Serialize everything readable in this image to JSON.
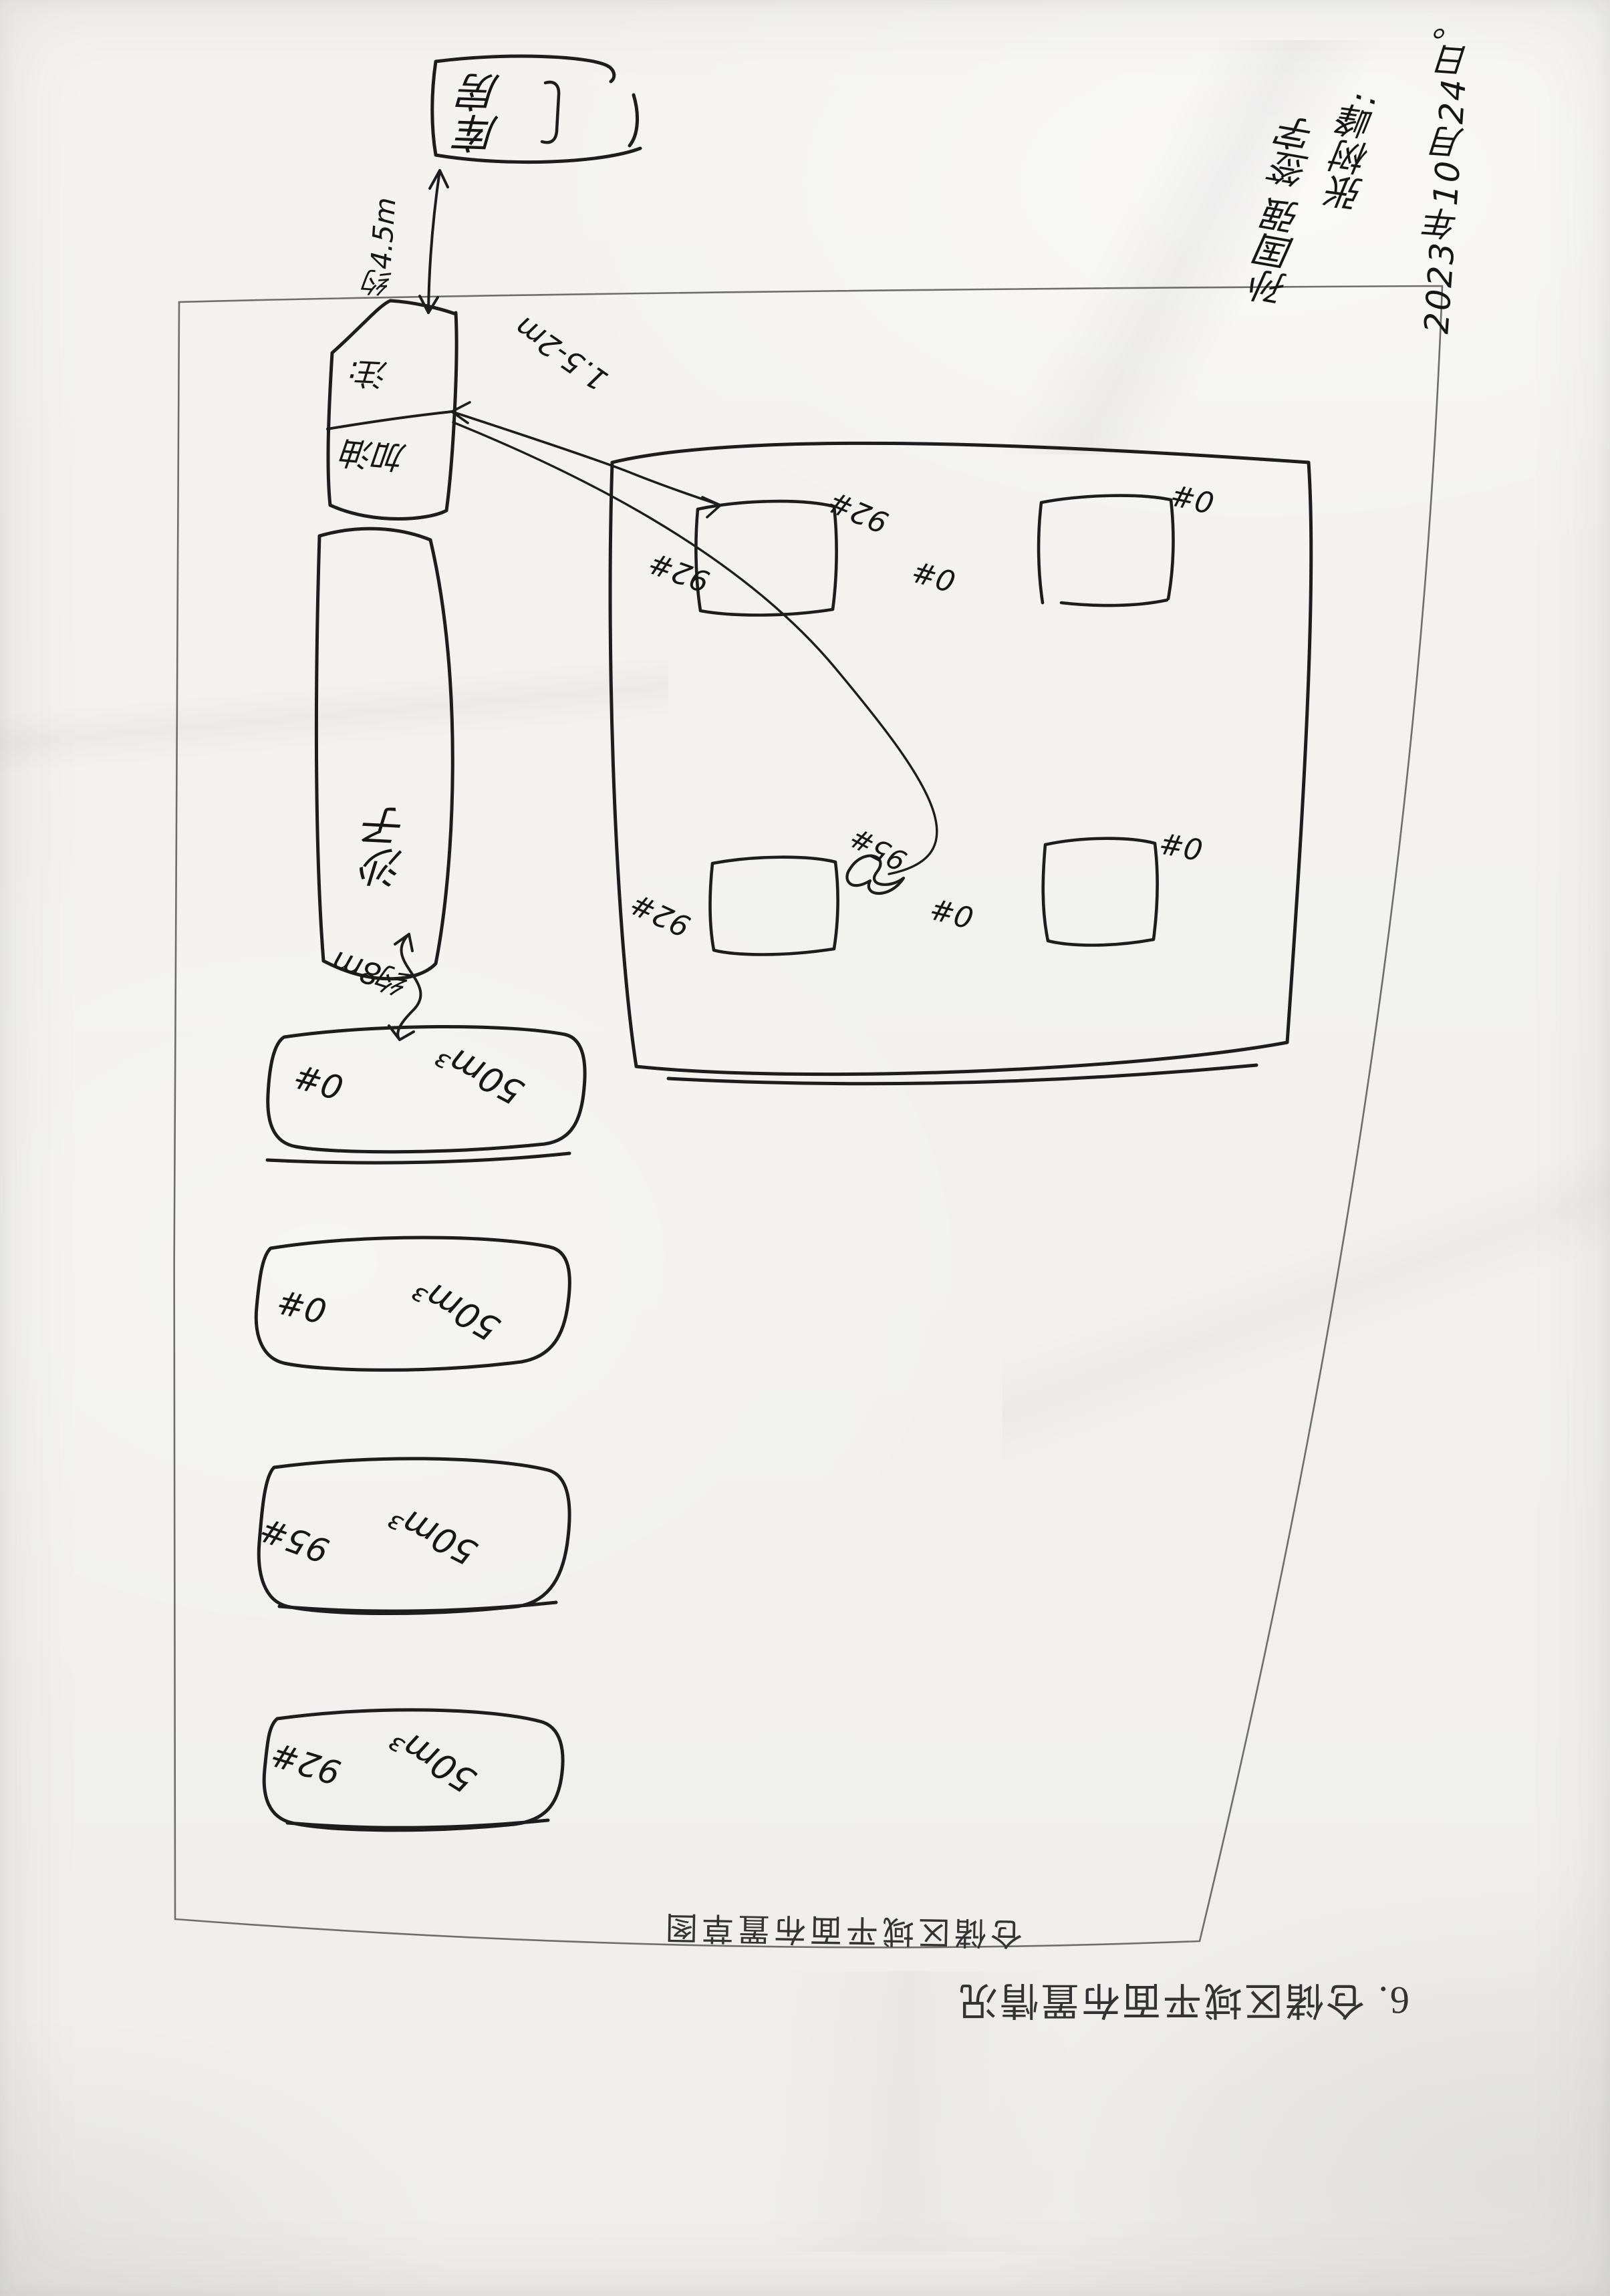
{
  "page": {
    "title": "6. 仓储区域平面布置情况",
    "caption": "仓储区域平面布置草图"
  },
  "handwriting": {
    "date": "2023年10月24日。",
    "line2": "张树峰:",
    "line3": "孙国强 签字"
  },
  "yard": {
    "building_label": "库房",
    "building_distance": "约4.5m",
    "note_cell_top": "注:",
    "note_cell_bottom": "加油",
    "pipe_distance": "1.5-2m",
    "sand_label": "沙子",
    "gap_label": "约8m"
  },
  "storage_tanks": [
    {
      "grade": "0#",
      "volume": "50m³"
    },
    {
      "grade": "0#",
      "volume": "50m³"
    },
    {
      "grade": "95#",
      "volume": "50m³"
    },
    {
      "grade": "92#",
      "volume": "50m³"
    }
  ],
  "buried_tanks": {
    "r1_left": "92#",
    "r1_right": "92#",
    "r2_left": "0#",
    "r2_right": "0#",
    "r3_left": "92#",
    "r3_crossed": "95#",
    "r4_left": "0#",
    "r4_right": "0#"
  },
  "colors": {
    "paper": "#f2f1ee",
    "ink": "#1d1d1d",
    "print_text": "#333333",
    "border_line": "#6e6e6e"
  }
}
